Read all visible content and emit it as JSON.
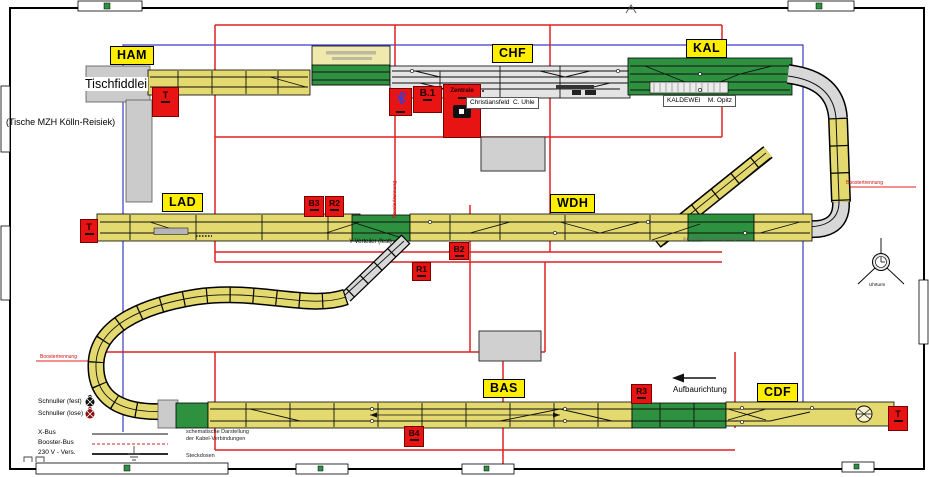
{
  "plan": {
    "stations": {
      "ham": "HAM",
      "chf": "CHF",
      "kal": "KAL",
      "lad": "LAD",
      "wdh": "WDH",
      "bas": "BAS",
      "cdf": "CDF"
    },
    "boxes": {
      "t": "T",
      "b1": "B.1",
      "b2": "B2",
      "b3": "B3",
      "b4": "B4",
      "r1": "R1",
      "r2": "R2",
      "r3": "R3",
      "zentrale": "Zentrale"
    },
    "labels": {
      "tischfiddlei": "Tischfiddlei",
      "tische_mzh": "(Tische MZH Kölln-Reisiek)",
      "christiansfeld": "Christiansfeld  C. Uhle",
      "kaldewei": "KALDEWEI    M. Opitz",
      "y_verteiler": "Y-Verteiler (fest)",
      "zusaetzliche_kreuzung": "zusätzliche Kreuzungsmöglichkeit",
      "aufbaurichtung": "Aufbaurichtung",
      "boostertrennung": "Boostertrennung",
      "uhrturm": "Uhrturm"
    },
    "legend": {
      "schnuller_fest": "Schnuller (fest)",
      "schnuller_lose": "Schnuller (lose)",
      "x_bus": "X-Bus",
      "booster_bus": "Booster-Bus",
      "v230": "230 V - Vers.",
      "kabel_note_1": "schematische Darstellung",
      "kabel_note_2": "der Kabel-Verbindungen",
      "steckdosen": "Steckdosen"
    },
    "colors": {
      "module_yellow": "#e3d96e",
      "module_pale_yellow": "#efe9ad",
      "module_green": "#2e9140",
      "module_gray": "#d9d9d9",
      "station_gray": "#e4e4e4",
      "label_yellow": "#ffee00",
      "box_red": "#e81313",
      "cable_red": "#e02020",
      "cable_blue": "#3a3ac8"
    }
  }
}
